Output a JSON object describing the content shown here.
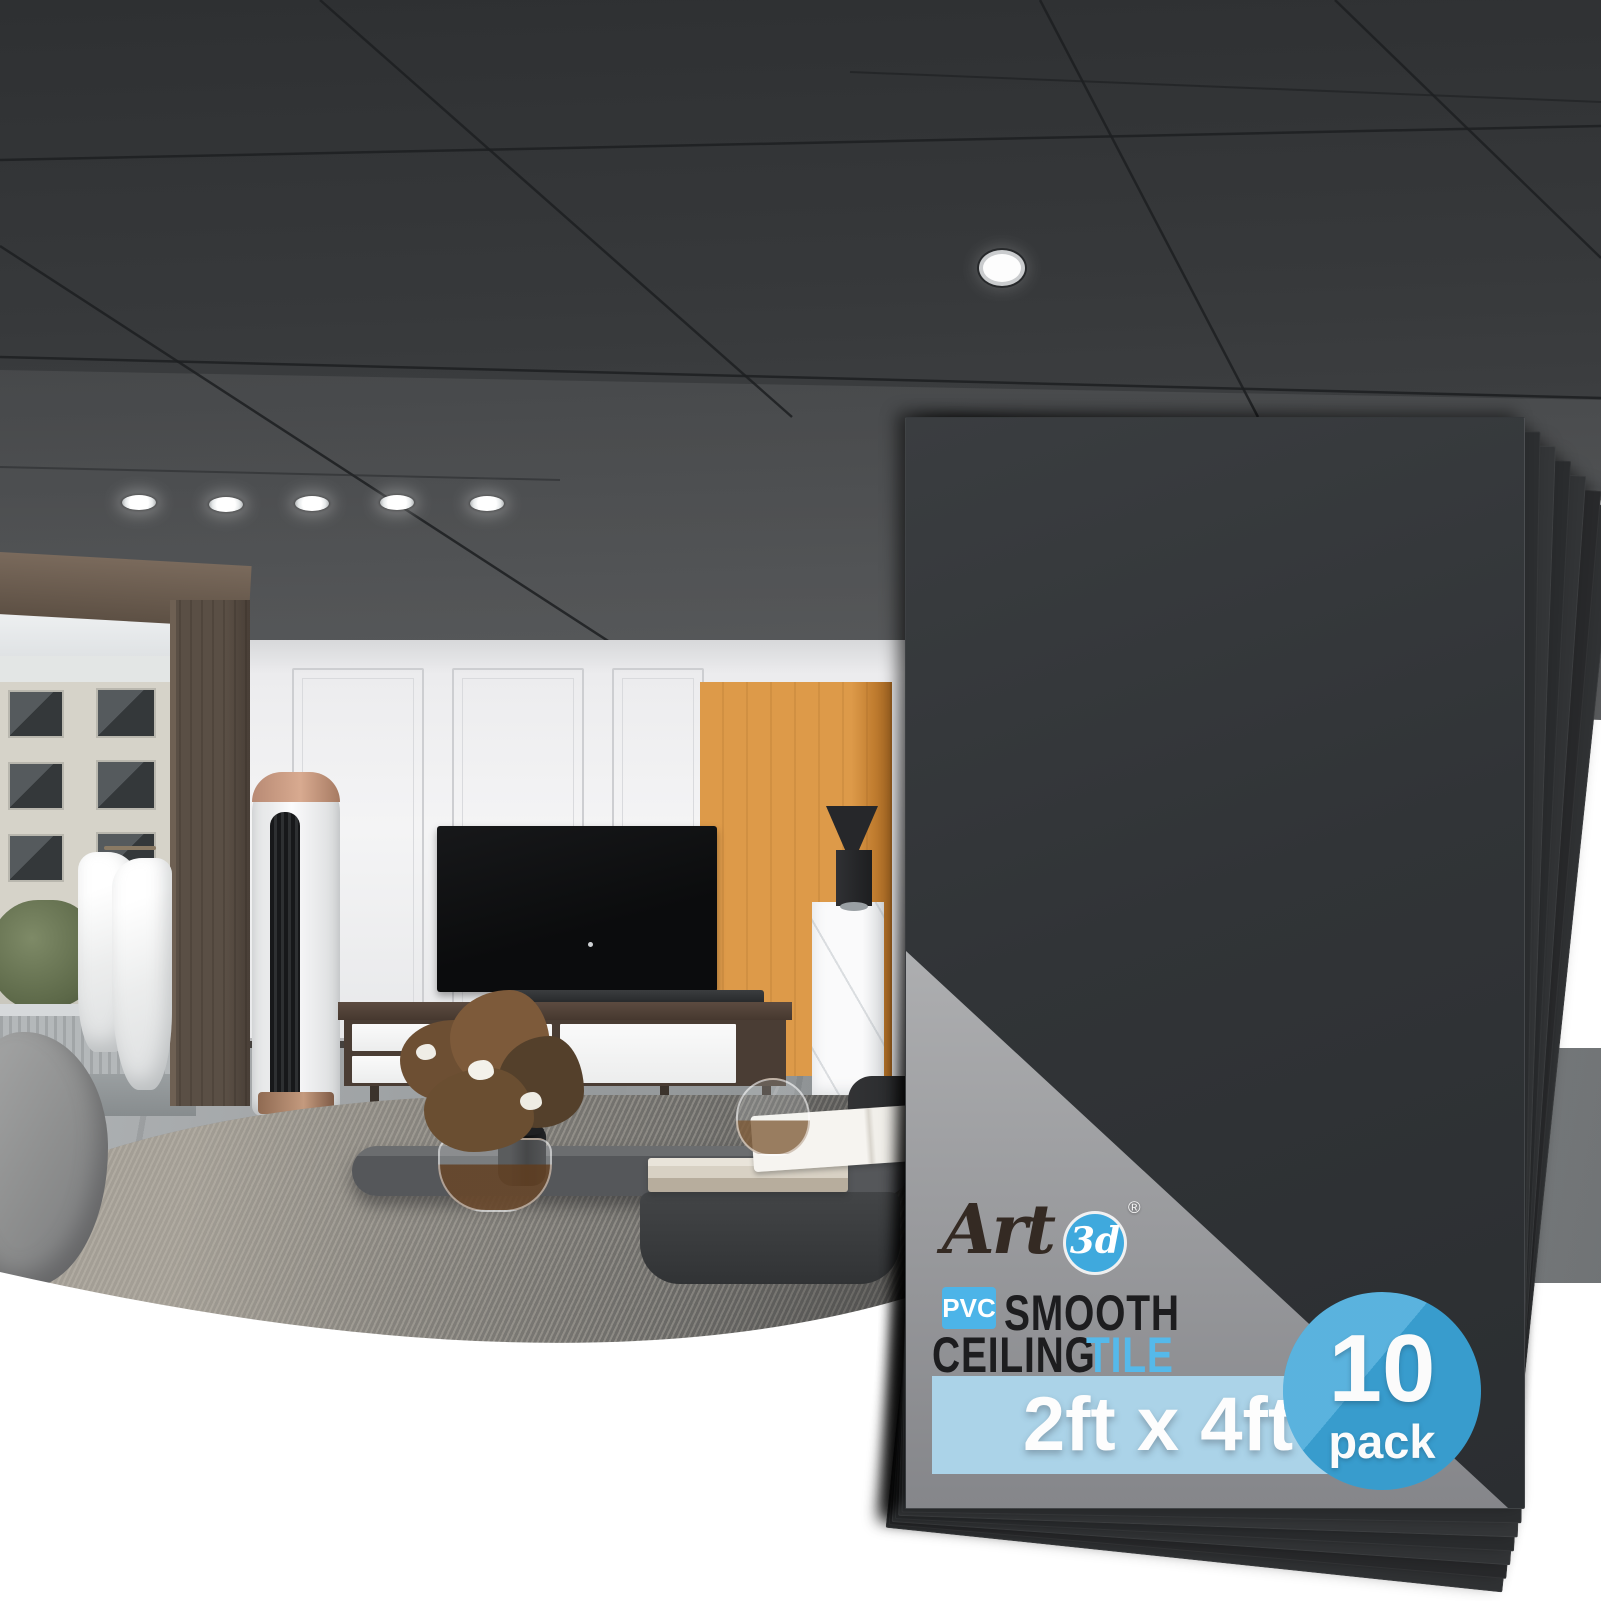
{
  "badge": {
    "brand": {
      "art": "Art",
      "threed": "3d",
      "registered": "®"
    },
    "line1": {
      "pvc": "PVC",
      "smooth": "SMOOTH"
    },
    "line2": {
      "ceiling": "CEILING",
      "tile": "TILE"
    },
    "size_label": "2ft x 4ft",
    "pack": {
      "count": "10",
      "word": "pack"
    }
  },
  "colors": {
    "accent_blue": "#3fa9dd",
    "badge_blue": "#4cb4e8",
    "band_blue": "#abd3e8",
    "pack_circle_blue": "#3ba4d8",
    "panel_dark": "#313437",
    "triangle_gray_top": "#c9cacc",
    "triangle_gray_bottom": "#85868a",
    "ceiling_dark": "#3a3c3e",
    "wall_white": "#f4f4f5",
    "orange_accent": "#dd9a49"
  },
  "scene": {
    "description": "Modern living room with black smooth drop-ceiling tiles, recessed lights, white paneled wall, orange accent panel, TV console, marble pedestal, coffee tables and gray rug; stack of 10 black ceiling panels in front"
  }
}
